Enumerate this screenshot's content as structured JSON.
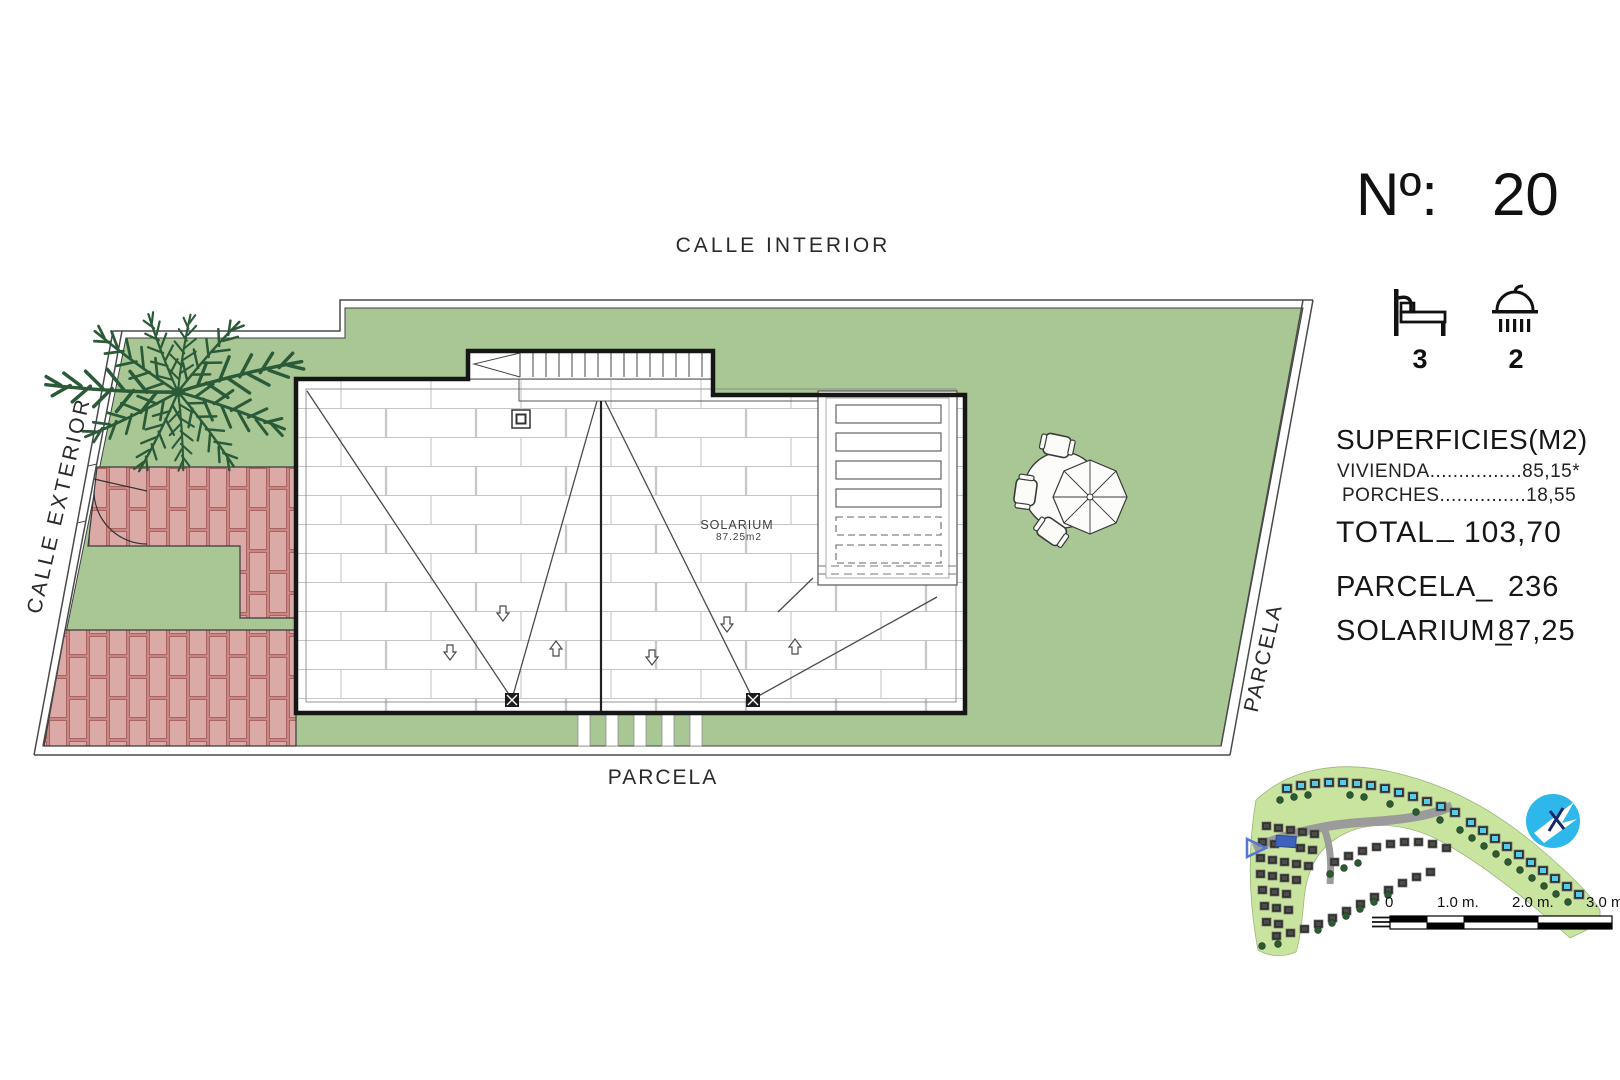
{
  "plan": {
    "street_top": "CALLE INTERIOR",
    "street_left": "CALLE EXTERIOR",
    "parcel_bottom": "PARCELA",
    "parcel_right": "PARCELA",
    "solarium_name": "SOLARIUM",
    "solarium_area": "87.25m2"
  },
  "panel": {
    "number_label": "Nº:",
    "number_value": "20",
    "bedrooms": "3",
    "bathrooms": "2",
    "areas_title": "SUPERFICIES(M2)",
    "line_vivienda": "VIVIENDA................85,15*",
    "line_porches": "PORCHES...............18,55",
    "total_label": "TOTAL",
    "total_sep": "_",
    "total_value": "103,70",
    "parcela_label": "PARCELA_",
    "parcela_value": "236",
    "solarium_label": "SOLARIUM_",
    "solarium_value": "87,25"
  },
  "scalebar": {
    "labels": [
      "0",
      "1.0 m.",
      "2.0 m.",
      "3.0 m."
    ]
  },
  "icons": {
    "bedrooms": "bed-icon",
    "bathrooms": "shower-icon",
    "north": "north-arrow-logo",
    "pointer": "plot-pointer-icon"
  },
  "colors": {
    "lawn": "#a8c795",
    "brick_fill": "#d9a19d",
    "brick_line": "#a96361",
    "palm": "#2b5a38",
    "logo_blue": "#2eb7ea",
    "highlight_plot": "#3d63bd",
    "minimap_green": "#c9e49f"
  }
}
